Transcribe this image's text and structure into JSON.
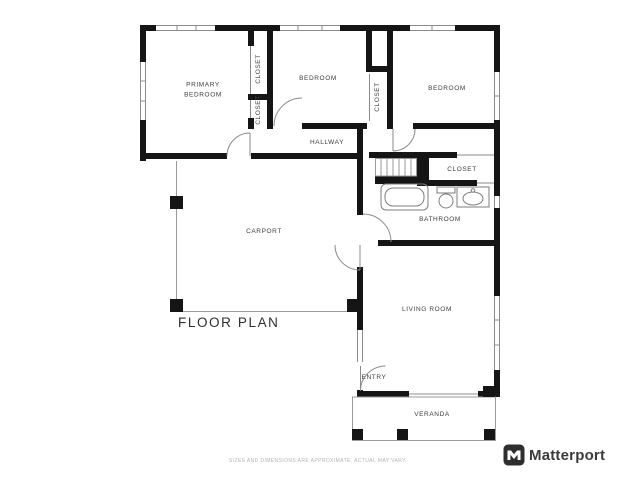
{
  "title": "FLOOR PLAN",
  "rooms": {
    "primary_bedroom": "PRIMARY BEDROOM",
    "bedroom_center": "BEDROOM",
    "bedroom_right": "BEDROOM",
    "closet_a": "CLOSET",
    "closet_b": "CLOSET",
    "closet_c": "CLOSET",
    "closet_d": "CLOSET",
    "hallway": "HALLWAY",
    "bathroom": "BATHROOM",
    "carport": "CARPORT",
    "living_room": "LIVING ROOM",
    "entry": "ENTRY",
    "veranda": "VERANDA"
  },
  "footer": {
    "disclaimer": "SIZES AND DIMENSIONS ARE APPROXIMATE, ACTUAL MAY VARY.",
    "brand": "Matterport",
    "brand_icon": "matterport-m-logo"
  },
  "colors": {
    "wall": "#151515",
    "thin_line": "#8c8c8c",
    "fixture_line": "#7d7d7d",
    "label_text": "#3d3d3d",
    "disclaimer_text": "#b3b3b3",
    "brand_text": "#3b3b3b"
  }
}
